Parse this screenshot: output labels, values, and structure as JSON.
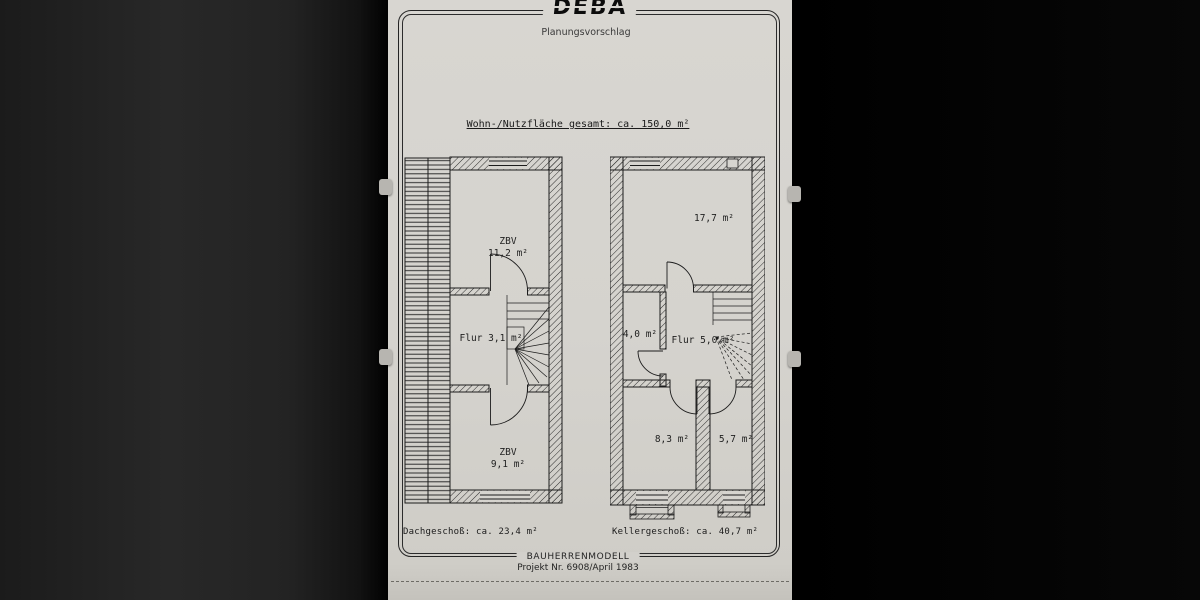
{
  "colors": {
    "paper": "#d6d4cf",
    "ink": "#1c1c1c",
    "background_left": "#232323",
    "background_right": "#060606"
  },
  "header": {
    "logo": "DEBA",
    "subtitle": "Planungsvorschlag"
  },
  "title": "Wohn-/Nutzfläche gesamt: ca. 150,0 m²",
  "plans": {
    "dachgeschoss": {
      "caption": "Dachgeschoß: ca. 23,4 m²",
      "rooms": [
        {
          "line1": "ZBV",
          "line2": "11,2 m²"
        },
        {
          "line1": "Flur 3,1 m²",
          "line2": ""
        },
        {
          "line1": "ZBV",
          "line2": "9,1 m²"
        }
      ]
    },
    "kellergeschoss": {
      "caption": "Kellergeschoß: ca. 40,7 m²",
      "rooms": [
        {
          "line1": "17,7 m²"
        },
        {
          "line1": "4,0 m²"
        },
        {
          "line1": "Flur 5,0 m²"
        },
        {
          "line1": "8,3 m²"
        },
        {
          "line1": "5,7 m²"
        }
      ]
    }
  },
  "footer": {
    "model": "BAUHERRENMODELL",
    "project": "Projekt Nr. 6908/April 1983"
  }
}
